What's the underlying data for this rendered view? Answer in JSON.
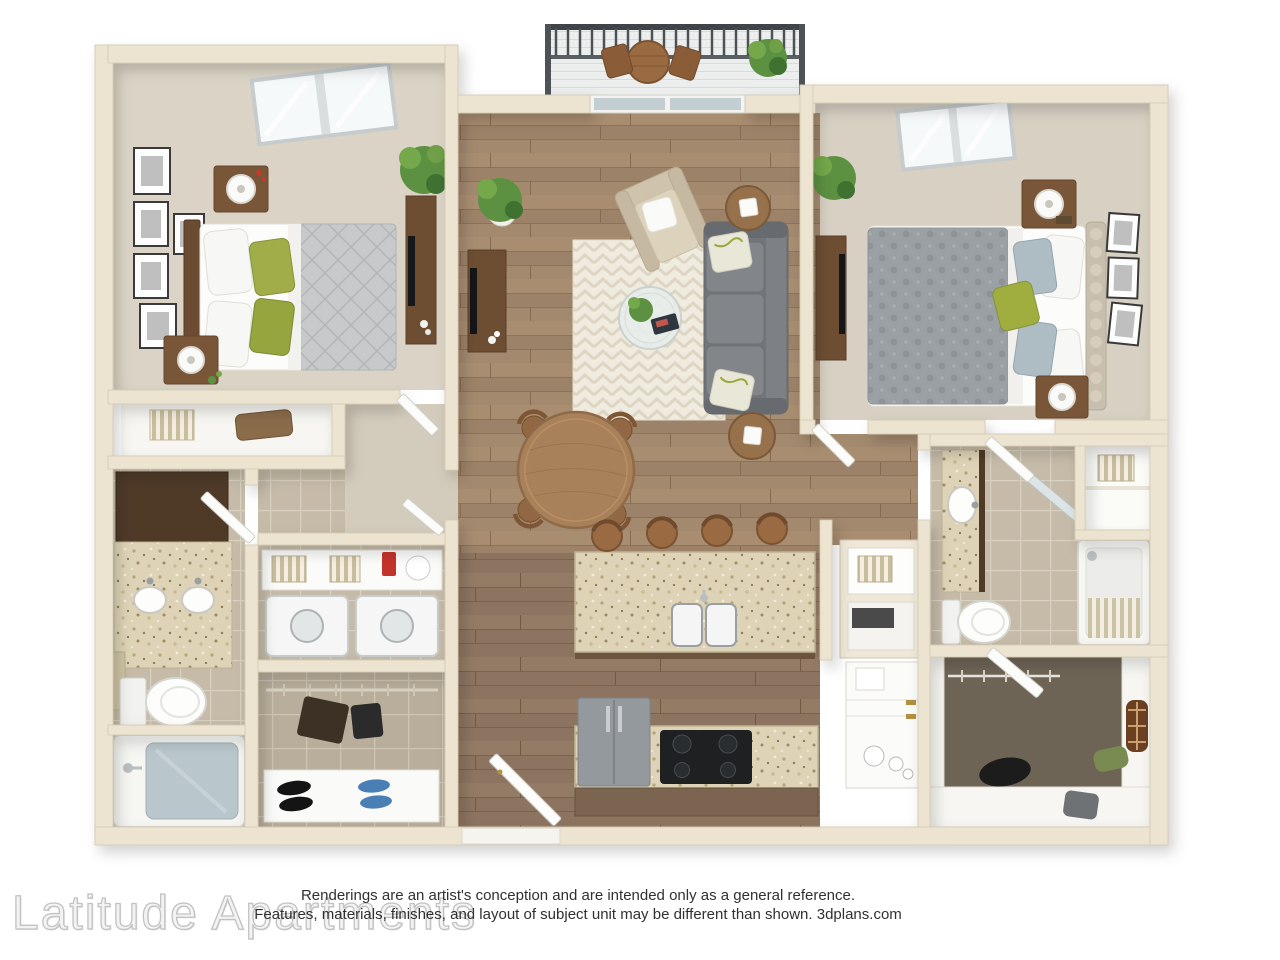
{
  "footer": {
    "watermark": "Latitude Apartments",
    "disclaimer_line1": "Renderings are an artist's conception and are intended only as a general reference.",
    "disclaimer_line2": "Features, materials, finishes, and layout of subject unit may be different than shown. 3dplans.com"
  },
  "colors": {
    "background": "#ffffff",
    "wall_fill": "#ece4d1",
    "wall_edge": "#d6cbb4",
    "wood_living": "#a3896e",
    "wood_kitchen": "#8d7460",
    "carpet": "#dbd4c6",
    "tile_bath": "#c6bba8",
    "granite": "#ded3b6",
    "cabinet_dark_wood": "#6e4e33",
    "sofa_gray": "#75797d",
    "accent_green_pillow": "#9fae3e",
    "plant_green": "#5d9142",
    "tub_water": "#b9c7cc",
    "appliance_gray": "#94999d",
    "watermark_gray": "#c2c2c2",
    "disclaimer_text": "#303030"
  }
}
